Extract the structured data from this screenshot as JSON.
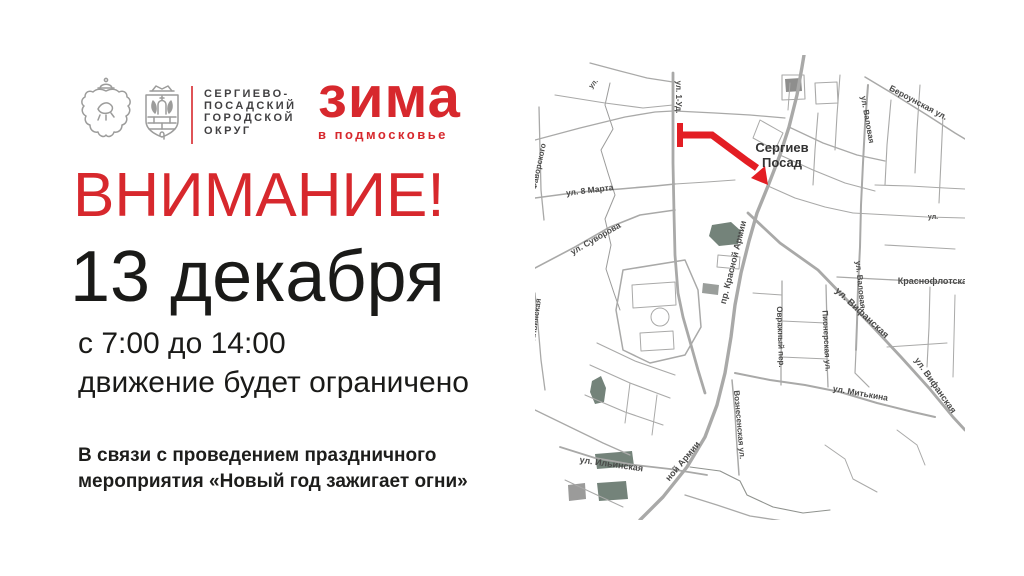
{
  "colors": {
    "accent": "#d7282d",
    "route": "#e31e24",
    "text_dark": "#1d1d1b",
    "org_text": "#414042",
    "map_road": "#a9a9a8",
    "map_label": "#4a4a49",
    "map_green": "#74837a",
    "map_city_label": "#333333"
  },
  "header": {
    "org_lines": [
      "СЕРГИЕВО-",
      "ПОСАДСКИЙ",
      "ГОРОДСКОЙ",
      "ОКРУГ"
    ],
    "brand_title": "зима",
    "brand_subtitle": "в подмосковье"
  },
  "announcement": {
    "attention": "ВНИМАНИЕ!",
    "date": "13 декабря",
    "time_range": "с 7:00 до 14:00",
    "restriction": "движение будет ограничено",
    "details_lines": [
      "В связи с проведением праздничного",
      "мероприятия «Новый год зажигает огни»"
    ]
  },
  "map": {
    "city": {
      "lines": [
        "Сергиев",
        "Посад"
      ],
      "x": 247,
      "y": 97,
      "dy": 15,
      "size": 13
    },
    "route": {
      "line": "145,80 177,80 212,106 222,113",
      "cap": "145,68 145,92",
      "arrow": "233,130 216,123 230,111",
      "width": 7,
      "cap_width": 6
    },
    "roads": [
      {
        "p": "105,465 128,442 152,412 170,382 182,350 190,318 196,282 200,250 206,218 214,186 222,158 233,131 245,100 254,72 262,40 267,12 269,0",
        "w": 3.4
      },
      {
        "p": "138,18 138,62 138,108 139,158 140,200 143,238 148,262 156,290 163,315 170,338",
        "w": 2.8
      },
      {
        "p": "333,30 330,70 328,108 326,150 325,192 323,233 322,268 321,295",
        "w": 2
      },
      {
        "p": "213,158 245,188 283,215 310,243 338,272 366,302 394,333 418,362 430,375",
        "w": 2.8
      },
      {
        "p": "200,318 235,325 270,330 305,337 342,348 378,357 400,362",
        "w": 2
      },
      {
        "p": "247,226 247,266 246,302 246,330",
        "w": 1.3
      },
      {
        "p": "291,230 292,270 292,305 293,332",
        "w": 1.3
      },
      {
        "p": "197,325 200,358 202,392 204,420",
        "w": 1.5
      },
      {
        "p": "330,22 360,40 392,60 420,78 430,84",
        "w": 1.5
      },
      {
        "p": "302,222 340,224 380,226 430,228",
        "w": 1.3
      },
      {
        "p": "0,143 45,137 85,134 120,131 140,129",
        "w": 1.6
      },
      {
        "p": "0,213 40,192 75,172 105,160 140,155",
        "w": 1.6
      },
      {
        "p": "4,52 5,95 6,135 9,165",
        "w": 1.3
      },
      {
        "p": "0,238 3,270 6,305 10,335",
        "w": 1.3
      },
      {
        "p": "25,392 60,403 100,410 135,414 172,420",
        "w": 1.8
      },
      {
        "p": "75,28 70,50 78,74 66,95 73,118 80,140 70,164 76,190 71,214 79,238 85,255",
        "w": 1,
        "c": "#9b9b9a"
      },
      {
        "p": "0,85 45,73 90,62 120,57 138,56",
        "w": 1.3
      },
      {
        "p": "55,8 85,16 112,23 138,27",
        "w": 1.2
      },
      {
        "p": "20,40 70,48 108,53 138,50",
        "w": 1.1
      },
      {
        "p": "140,56 180,58 215,60 250,63",
        "w": 1.2
      },
      {
        "p": "143,78 172,80 205,100",
        "w": 1.2
      },
      {
        "p": "140,129 172,127 200,125",
        "w": 1.1
      },
      {
        "p": "254,72 288,88 322,100 350,106",
        "w": 1.3
      },
      {
        "p": "245,100 278,115 310,128 340,136",
        "w": 1.1
      },
      {
        "p": "233,131 260,143 290,152 318,158",
        "w": 1.1
      },
      {
        "p": "283,58 280,95 278,130",
        "w": 1.1
      },
      {
        "p": "305,20 302,60 300,95",
        "w": 1.1
      },
      {
        "p": "356,45 352,90 350,130",
        "w": 1.1
      },
      {
        "p": "385,30 382,75 380,118",
        "w": 1.1
      },
      {
        "p": "408,60 406,105 404,148",
        "w": 1.1
      },
      {
        "p": "318,158 355,160 392,162 430,163",
        "w": 1.1
      },
      {
        "p": "340,130 375,131 410,133 430,134",
        "w": 1.1
      },
      {
        "p": "350,190 385,192 420,194",
        "w": 1.1
      },
      {
        "p": "395,232 394,272 392,312",
        "w": 1.1
      },
      {
        "p": "420,240 419,282 418,322",
        "w": 1
      },
      {
        "p": "321,295 320,318 334,332",
        "w": 1.2
      },
      {
        "p": "352,292 382,290 412,288",
        "w": 1
      },
      {
        "p": "218,238 247,240",
        "w": 1
      },
      {
        "p": "247,266 291,268",
        "w": 1
      },
      {
        "p": "246,302 293,304",
        "w": 1
      },
      {
        "p": "55,310 95,328 135,343",
        "w": 1.1
      },
      {
        "p": "50,340 90,357 128,370",
        "w": 1.1
      },
      {
        "p": "62,288 100,306 140,320",
        "w": 1.1
      },
      {
        "p": "95,328 90,368",
        "w": 1
      },
      {
        "p": "122,340 117,380",
        "w": 1
      },
      {
        "p": "0,355 35,372 68,388 95,400",
        "w": 1.3
      },
      {
        "p": "30,425 62,440 88,452",
        "w": 1
      },
      {
        "p": "150,440 182,450 215,461 248,466",
        "w": 1.3
      },
      {
        "p": "155,412 185,416 205,426 212,440 238,452 268,458 295,455",
        "w": 1.1,
        "c": "#8f928e"
      },
      {
        "p": "290,390 310,404 318,424 342,437",
        "w": 1
      },
      {
        "p": "362,375 382,390 390,410",
        "w": 1
      },
      {
        "p": "88,215 150,205 163,235 166,272 150,300 115,308 88,295 81,255 88,215",
        "w": 1.5
      },
      {
        "p": "97,230 140,227 141,250 98,253 97,230",
        "w": 1
      },
      {
        "p": "105,278 138,276 139,294 106,296 105,278",
        "w": 1
      },
      {
        "p": "247,20 247,45 270,44 269,20 247,20",
        "w": 1.1
      },
      {
        "p": "280,28 302,27 303,48 281,49 280,28",
        "w": 1.1
      },
      {
        "p": "225,65 248,78 240,95 218,83 225,65",
        "w": 1
      },
      {
        "p": "255,28 253,55",
        "w": 1
      },
      {
        "p": "183,200 205,202 204,214 182,212 183,200",
        "w": 1
      }
    ],
    "circles": [
      {
        "cx": 125,
        "cy": 262,
        "r": 9
      }
    ],
    "shapes": [
      {
        "pts": "177,170 196,167 206,176 203,189 184,191 174,181",
        "c": "#74837a"
      },
      {
        "pts": "57,326 66,321 71,333 69,347 60,349 55,337",
        "c": "#74837a"
      },
      {
        "pts": "60,399 97,396 99,411 62,414",
        "c": "#74837a"
      },
      {
        "pts": "62,428 91,426 93,444 64,446",
        "c": "#74837a"
      },
      {
        "pts": "168,228 184,230 183,240 167,238",
        "c": "#9a9e9b"
      },
      {
        "pts": "250,24 266,23 267,36 251,37",
        "c": "#8e8e8d"
      },
      {
        "pts": "33,430 50,428 51,444 34,446",
        "c": "#9b9b9a"
      }
    ],
    "labels": [
      {
        "t": "ул. 1-Уд.",
        "x": 141,
        "y": 42,
        "r": 90,
        "s": 8
      },
      {
        "t": "Фаворского",
        "x": 6,
        "y": 112,
        "r": -78,
        "s": 8
      },
      {
        "t": "ул. 8 Марта",
        "x": 55,
        "y": 138,
        "r": -7,
        "s": 8.5
      },
      {
        "t": "ул. Суворова",
        "x": 62,
        "y": 186,
        "r": -30,
        "s": 8.5
      },
      {
        "t": "ул. Ильинская",
        "x": 2,
        "y": 272,
        "r": -82,
        "s": 8
      },
      {
        "t": "ул. Ильинская",
        "x": 76,
        "y": 412,
        "r": 8,
        "s": 9
      },
      {
        "t": "пр. Красной Армии",
        "x": 201,
        "y": 208,
        "r": -76,
        "s": 9
      },
      {
        "t": "ной Армии",
        "x": 150,
        "y": 408,
        "r": -50,
        "s": 9
      },
      {
        "t": "Вознесенская ул.",
        "x": 202,
        "y": 370,
        "r": 85,
        "s": 8
      },
      {
        "t": "ул. Валовая",
        "x": 330,
        "y": 65,
        "r": 80,
        "s": 8
      },
      {
        "t": "ул. Валовая",
        "x": 323,
        "y": 230,
        "r": 84,
        "s": 8
      },
      {
        "t": "Бероунская ул.",
        "x": 382,
        "y": 50,
        "r": 28,
        "s": 8.5
      },
      {
        "t": "Краснофлотская",
        "x": 400,
        "y": 229,
        "r": 0,
        "s": 9
      },
      {
        "t": "Овражный пер.",
        "x": 243,
        "y": 282,
        "r": 88,
        "s": 8
      },
      {
        "t": "Пионерская ул.",
        "x": 289,
        "y": 286,
        "r": 87,
        "s": 8
      },
      {
        "t": "ул. Вифанская",
        "x": 325,
        "y": 260,
        "r": 43,
        "s": 9.5
      },
      {
        "t": "ул. Вифанская",
        "x": 398,
        "y": 332,
        "r": 55,
        "s": 9
      },
      {
        "t": "ул. Митькина",
        "x": 325,
        "y": 341,
        "r": 10,
        "s": 8.5
      },
      {
        "t": "ул.",
        "x": 60,
        "y": 30,
        "r": -50,
        "s": 7
      },
      {
        "t": "ул.",
        "x": 398,
        "y": 164,
        "r": 0,
        "s": 7
      }
    ]
  }
}
